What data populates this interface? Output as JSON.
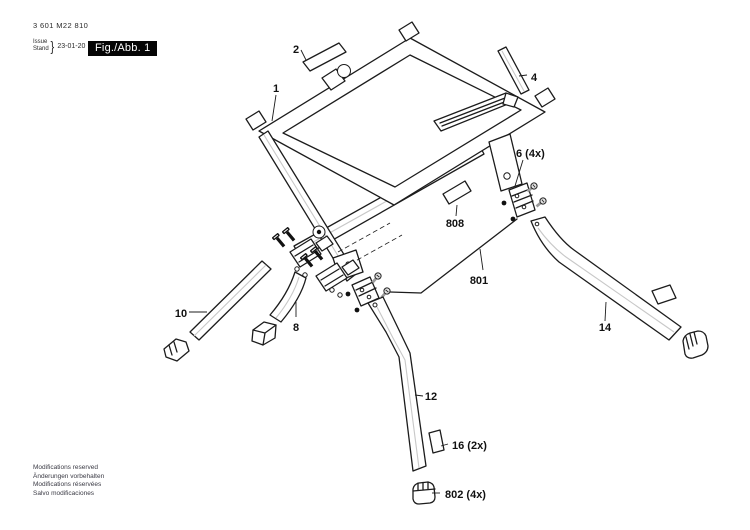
{
  "header": {
    "part_number": "3 601 M22 810",
    "issue_label_line1": "Issue",
    "issue_label_line2": "Stand",
    "brace": "}",
    "issue_date": "23-01-20",
    "figure_label": "Fig./Abb. 1"
  },
  "diagram": {
    "callouts": [
      {
        "ref": "1"
      },
      {
        "ref": "2"
      },
      {
        "ref": "4"
      },
      {
        "ref": "6 (4x)"
      },
      {
        "ref": "8"
      },
      {
        "ref": "10"
      },
      {
        "ref": "12"
      },
      {
        "ref": "14"
      },
      {
        "ref": "16 (2x)"
      },
      {
        "ref": "801"
      },
      {
        "ref": "802 (4x)"
      },
      {
        "ref": "808"
      }
    ]
  },
  "footer": {
    "lines": [
      "Modifications reserved",
      "Änderungen vorbehalten",
      "Modifications réservées",
      "Salvo modificaciones"
    ]
  },
  "colors": {
    "background": "#ffffff",
    "line": "#1c1c1c",
    "figure_box_bg": "#000000",
    "figure_box_text": "#ffffff"
  }
}
